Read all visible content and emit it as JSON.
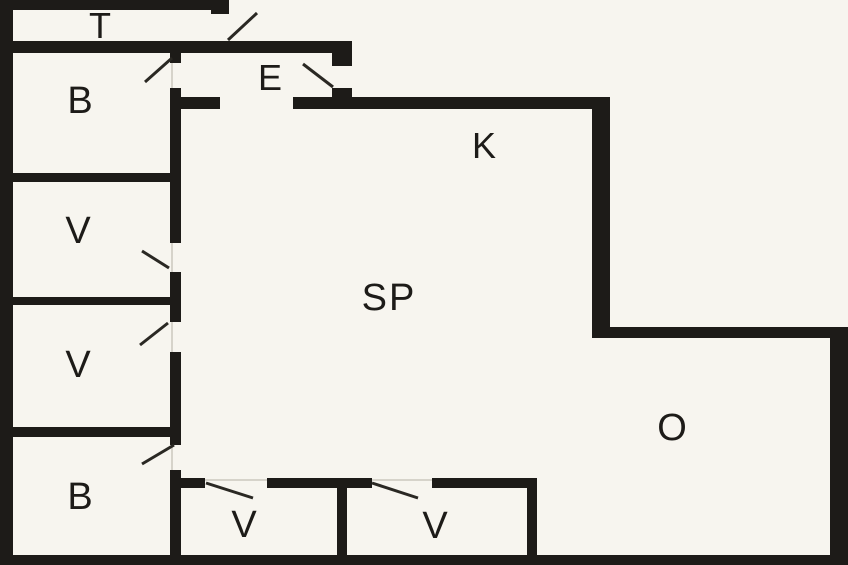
{
  "plan_title": "apartment floor plan",
  "colors": {
    "background": "#f7f5ef",
    "wall": "#1d1b18",
    "door_line": "#2a2823",
    "threshold_line": "#d6d3ca"
  },
  "rooms": [
    {
      "id": "room-t",
      "label": "T"
    },
    {
      "id": "room-b-upper",
      "label": "B"
    },
    {
      "id": "room-v-upper-1",
      "label": "V"
    },
    {
      "id": "room-v-upper-2",
      "label": "V"
    },
    {
      "id": "room-b-lower",
      "label": "B"
    },
    {
      "id": "room-e",
      "label": "E"
    },
    {
      "id": "room-k",
      "label": "K"
    },
    {
      "id": "room-sp",
      "label": "SP"
    },
    {
      "id": "room-v-bottom-1",
      "label": "V"
    },
    {
      "id": "room-v-bottom-2",
      "label": "V"
    },
    {
      "id": "room-o",
      "label": "O"
    }
  ]
}
